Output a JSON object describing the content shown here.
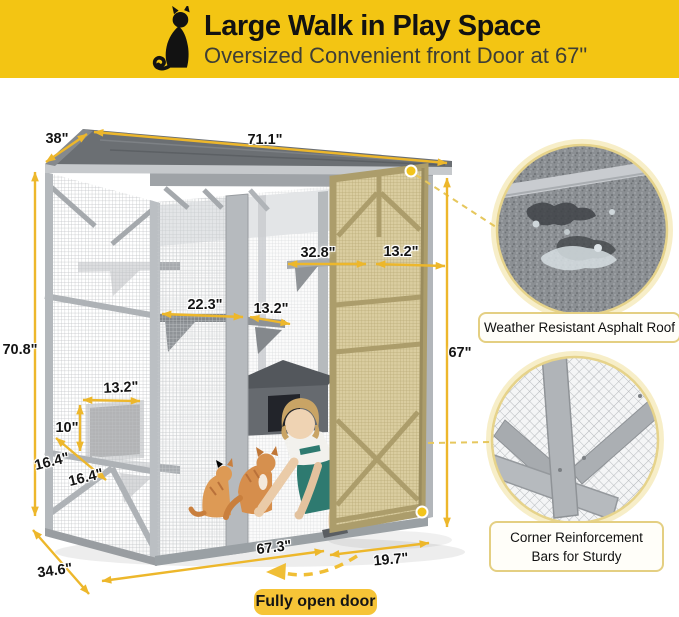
{
  "banner": {
    "title": "Large Walk in Play Space",
    "subtitle": "Oversized Convenient front Door at 67\"",
    "icon": "cat-silhouette",
    "bg_color": "#F3C513",
    "title_color": "#121212",
    "subtitle_color": "#3E3E36"
  },
  "dimensions": {
    "roof_depth": "38\"",
    "roof_width": "71.1\"",
    "total_height": "70.8\"",
    "upper_shelf_width": "32.8\"",
    "door_width": "13.2\"",
    "middle_shelf_width": "22.3\"",
    "middle_shelf_small": "13.2\"",
    "front_door_height": "67\"",
    "cubby_width": "13.2\"",
    "cubby_height": "10\"",
    "cubby_depth_front": "16.4\"",
    "cubby_depth_back": "16.4\"",
    "base_depth": "34.6\"",
    "base_width": "67.3\"",
    "door_open_width": "19.7\""
  },
  "callouts": {
    "roof": {
      "label": "Weather Resistant Asphalt Roof"
    },
    "corner": {
      "line1": "Corner Reinforcement",
      "line2": "Bars for Sturdy"
    }
  },
  "door_tag": {
    "label": "Fully open door",
    "bg_color": "#F6C437"
  },
  "palette": {
    "dimension_arrow": "#EDB72B",
    "connector_dash": "#E6C75D",
    "marker_dot": "#F2C41C",
    "door_wood": "#DACDA0",
    "frame_gray": "#B7BBBF",
    "roof_gray": "#64686C",
    "overalls_teal": "#2E7A70",
    "cat_orange": "#D68E4C"
  }
}
